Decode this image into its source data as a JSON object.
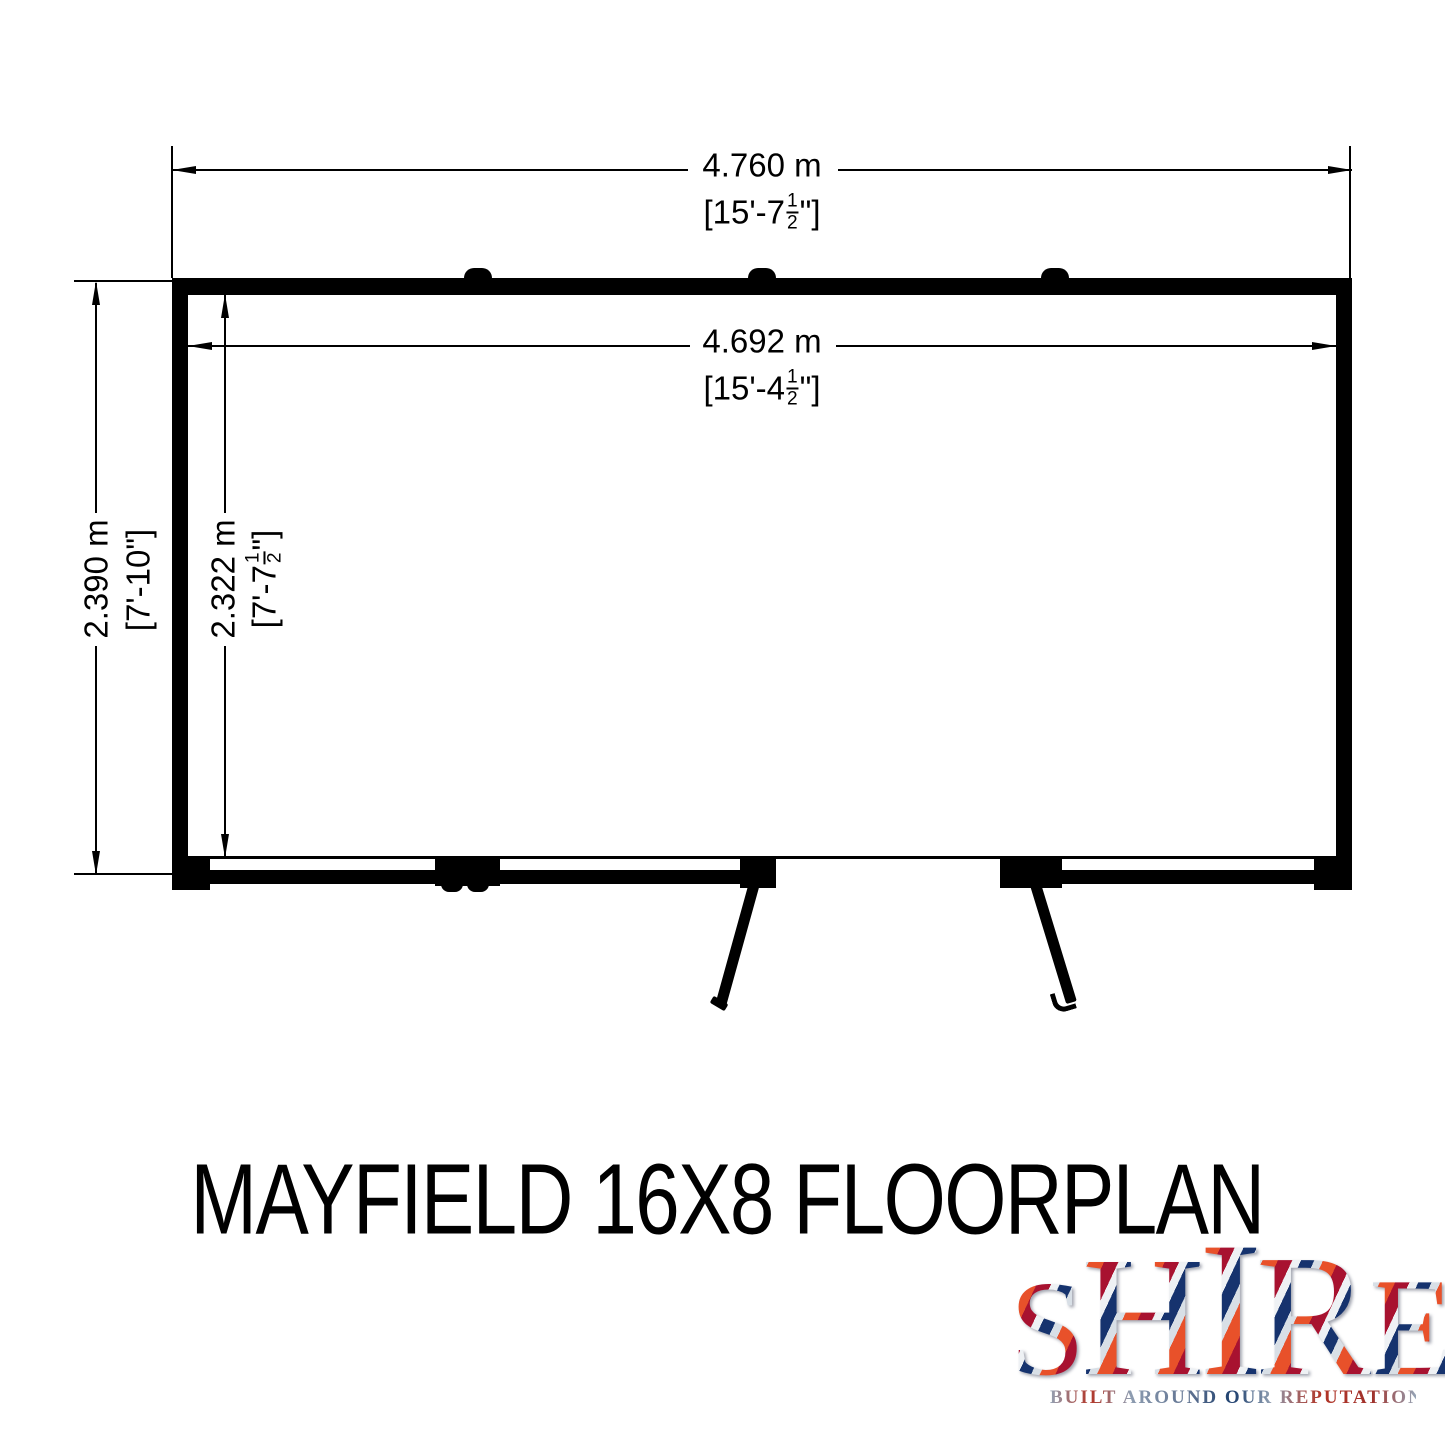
{
  "title": "MAYFIELD 16X8 FLOORPLAN",
  "colors": {
    "ink": "#000000",
    "logo_navy": "#16336e",
    "logo_red": "#e8512a",
    "logo_crimson": "#a81230",
    "logo_silver": "#d8dfe6",
    "tagline_blue": "#8d9cb0",
    "tagline_navy": "#1d3f6e",
    "tagline_red": "#b23527"
  },
  "dimensions": {
    "outer_width": {
      "metric": "4.760 m",
      "imp_pre": "[15'-7",
      "imp_num": "1",
      "imp_den": "2",
      "imp_post": "\"]"
    },
    "inner_width": {
      "metric": "4.692 m",
      "imp_pre": "[15'-4",
      "imp_num": "1",
      "imp_den": "2",
      "imp_post": "\"]"
    },
    "outer_depth": {
      "metric": "2.390 m",
      "imp_pre": "[7'-10\"]",
      "imp_num": "",
      "imp_den": "",
      "imp_post": ""
    },
    "inner_depth": {
      "metric": "2.322 m",
      "imp_pre": "[7'-7",
      "imp_num": "1",
      "imp_den": "2",
      "imp_post": "\"]"
    }
  },
  "logo": {
    "letters": [
      "S",
      "H",
      "I",
      "R",
      "E"
    ],
    "tagline": "BUILT AROUND OUR REPUTATION"
  }
}
